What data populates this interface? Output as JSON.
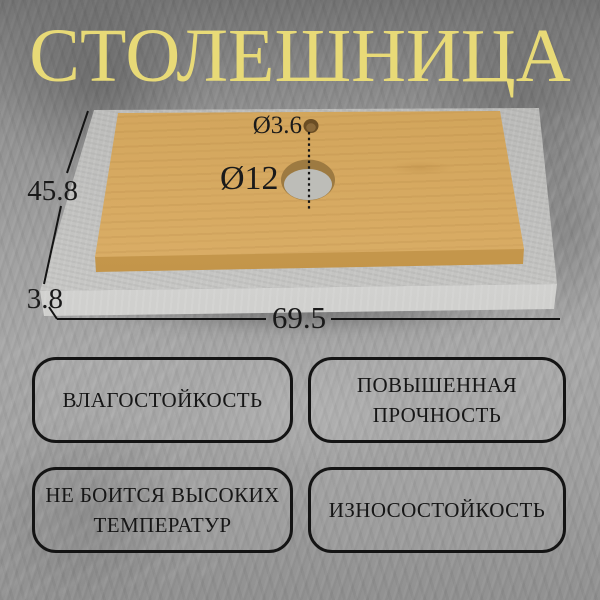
{
  "title": "СТОЛЕШНИЦА",
  "colors": {
    "title_text": "#E8DA77",
    "background_base": "#9C9C9C",
    "wood_surface": "#DFB46E",
    "concrete_slab": "#CDCDCB",
    "dimension_lines": "#141414",
    "badge_border": "#141414",
    "badge_text": "#161616"
  },
  "diagram": {
    "small_hole_diameter_label": "Ø3.6",
    "large_hole_diameter_label": "Ø12",
    "depth_label": "45.8",
    "thickness_label": "3.8",
    "width_label": "69.5"
  },
  "features": [
    {
      "label": "ВЛАГОСТОЙКОСТЬ"
    },
    {
      "label": "ПОВЫШЕННАЯ ПРОЧНОСТЬ"
    },
    {
      "label": "НЕ БОИТСЯ ВЫСОКИХ ТЕМПЕРАТУР"
    },
    {
      "label": "ИЗНОСОСТОЙКОСТЬ"
    }
  ]
}
